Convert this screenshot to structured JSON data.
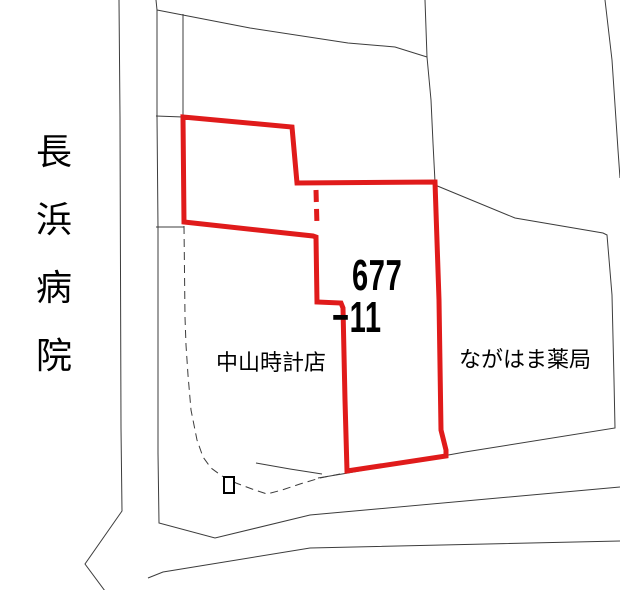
{
  "canvas": {
    "width": 620,
    "height": 590,
    "background": "#ffffff"
  },
  "colors": {
    "parcel_outline": "#e01b1b",
    "map_line": "#3c3c3c",
    "text": "#000000"
  },
  "labels": {
    "hospital": "長浜病院",
    "parcel_number_line1": "677",
    "parcel_number_line2": "−11",
    "watch_shop": "中山時計店",
    "pharmacy": "ながはま薬局"
  },
  "map": {
    "highlight_parcel": {
      "number": "677-11",
      "outline_width": 5,
      "points": [
        [
          183,
          117
        ],
        [
          292,
          127
        ],
        [
          297,
          183
        ],
        [
          435,
          182
        ],
        [
          439,
          300
        ],
        [
          441,
          430
        ],
        [
          446,
          450
        ],
        [
          446,
          456
        ],
        [
          347,
          471
        ],
        [
          345,
          400
        ],
        [
          343,
          308
        ],
        [
          341,
          303
        ],
        [
          317,
          302
        ],
        [
          316,
          237
        ],
        [
          313,
          236
        ],
        [
          184,
          222
        ]
      ],
      "dashed_segment": [
        [
          316,
          190
        ],
        [
          317,
          226
        ]
      ]
    },
    "building_marker": {
      "x": 224,
      "y": 477,
      "width": 10,
      "height": 16
    },
    "lines": [
      {
        "name": "road-left-outer-line",
        "points": [
          [
            119,
            0
          ],
          [
            120,
            117
          ],
          [
            121,
            428
          ],
          [
            122,
            511
          ],
          [
            85,
            564
          ],
          [
            105,
            591
          ]
        ]
      },
      {
        "name": "road-left-inner-line",
        "points": [
          [
            156,
            0
          ],
          [
            157,
            10
          ],
          [
            157,
            116
          ],
          [
            158,
            228
          ],
          [
            158,
            453
          ],
          [
            159,
            523
          ],
          [
            215,
            538
          ],
          [
            310,
            515
          ],
          [
            620,
            487
          ]
        ]
      },
      {
        "name": "road-top-diagonal-line",
        "points": [
          [
            157,
            10
          ],
          [
            250,
            28
          ],
          [
            348,
            43
          ],
          [
            395,
            47
          ],
          [
            427,
            57
          ]
        ]
      },
      {
        "name": "road-upper-vertical-line",
        "points": [
          [
            425,
            0
          ],
          [
            427,
            57
          ],
          [
            431,
            100
          ],
          [
            433,
            143
          ],
          [
            435,
            182
          ]
        ]
      },
      {
        "name": "parcel-boundary-top-line",
        "points": [
          [
            183,
            14
          ],
          [
            183,
            116
          ]
        ]
      },
      {
        "name": "boundary-tick-upper",
        "points": [
          [
            156,
            116
          ],
          [
            183,
            117
          ]
        ]
      },
      {
        "name": "boundary-tick-lower",
        "points": [
          [
            156,
            227
          ],
          [
            184,
            227
          ]
        ]
      },
      {
        "name": "parcel-boundary-curve",
        "dashed": true,
        "points": [
          [
            184,
            226
          ],
          [
            185,
            317
          ],
          [
            186,
            345
          ],
          [
            188,
            375
          ],
          [
            191,
            410
          ],
          [
            197,
            440
          ],
          [
            203,
            457
          ],
          [
            211,
            468
          ],
          [
            222,
            476
          ],
          [
            236,
            483
          ],
          [
            252,
            489
          ],
          [
            267,
            494
          ],
          [
            282,
            490
          ],
          [
            300,
            484
          ],
          [
            320,
            478
          ],
          [
            340,
            474
          ]
        ]
      },
      {
        "name": "road-right-edge-line",
        "points": [
          [
            435,
            185
          ],
          [
            515,
            218
          ],
          [
            603,
            233
          ],
          [
            607,
            235
          ],
          [
            612,
            295
          ],
          [
            614,
            380
          ],
          [
            615,
            428
          ],
          [
            465,
            452
          ],
          [
            348,
            473
          ],
          [
            318,
            478
          ]
        ]
      },
      {
        "name": "alley-upper-line",
        "points": [
          [
            256,
            463
          ],
          [
            290,
            469
          ],
          [
            322,
            474
          ]
        ]
      },
      {
        "name": "road-northeast-line",
        "points": [
          [
            605,
            0
          ],
          [
            612,
            60
          ],
          [
            618,
            150
          ],
          [
            620,
            178
          ]
        ]
      },
      {
        "name": "road-south-outer-line",
        "points": [
          [
            148,
            578
          ],
          [
            163,
            572
          ],
          [
            310,
            548
          ],
          [
            620,
            541
          ]
        ]
      }
    ]
  }
}
